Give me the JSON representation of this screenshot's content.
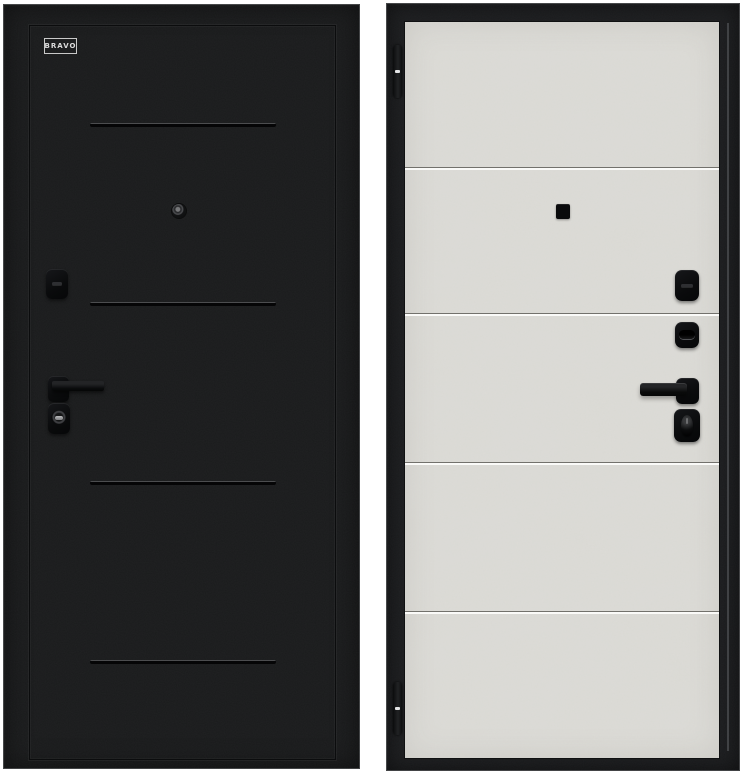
{
  "product": {
    "brand_label": "BRAVO",
    "views": {
      "exterior": {
        "label": "exterior-side-black-crinkle"
      },
      "interior": {
        "label": "interior-side-grey-concrete"
      }
    },
    "hardware_items": [
      "peephole",
      "night-latch-cover",
      "door-handle",
      "key-cylinder",
      "thumb-turn",
      "hinge-top",
      "hinge-bottom"
    ]
  },
  "colors": {
    "background": "#ffffff",
    "door_black": "#1a1b1c",
    "frame_black": "#1c1d1f",
    "panel_concrete": "#dcdbd6",
    "hardware_black": "#0c0d0e",
    "groove_highlight_light": "#fafaf8"
  }
}
